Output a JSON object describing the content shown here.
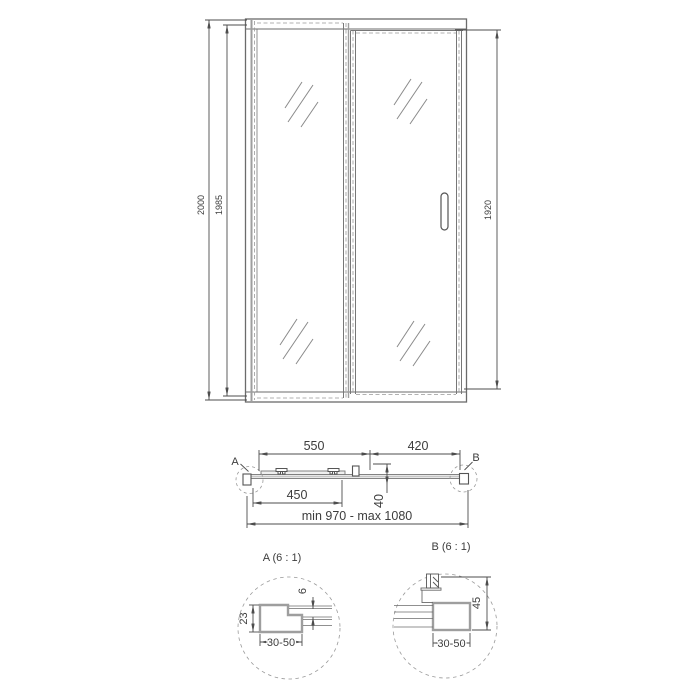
{
  "drawing": {
    "front": {
      "total_height": "2000",
      "inner_height": "1985",
      "door_height": "1920"
    },
    "plan": {
      "left_width": "550",
      "right_width": "420",
      "rail_width": "450",
      "depth": "40",
      "range": "min 970 - max 1080",
      "marker_a": "A",
      "marker_b": "B"
    },
    "detail_a": {
      "title": "A (6 : 1)",
      "profile_height": "23",
      "glass_gap": "6",
      "adjust_range": "30-50"
    },
    "detail_b": {
      "title": "B (6 : 1)",
      "profile_height": "45",
      "adjust_range": "30-50"
    }
  },
  "colors": {
    "line": "#4d4d4d",
    "thin_line": "#6b6b6b",
    "profile_gray": "#9e9e9e",
    "dash_gray": "#999999",
    "background": "#ffffff"
  }
}
